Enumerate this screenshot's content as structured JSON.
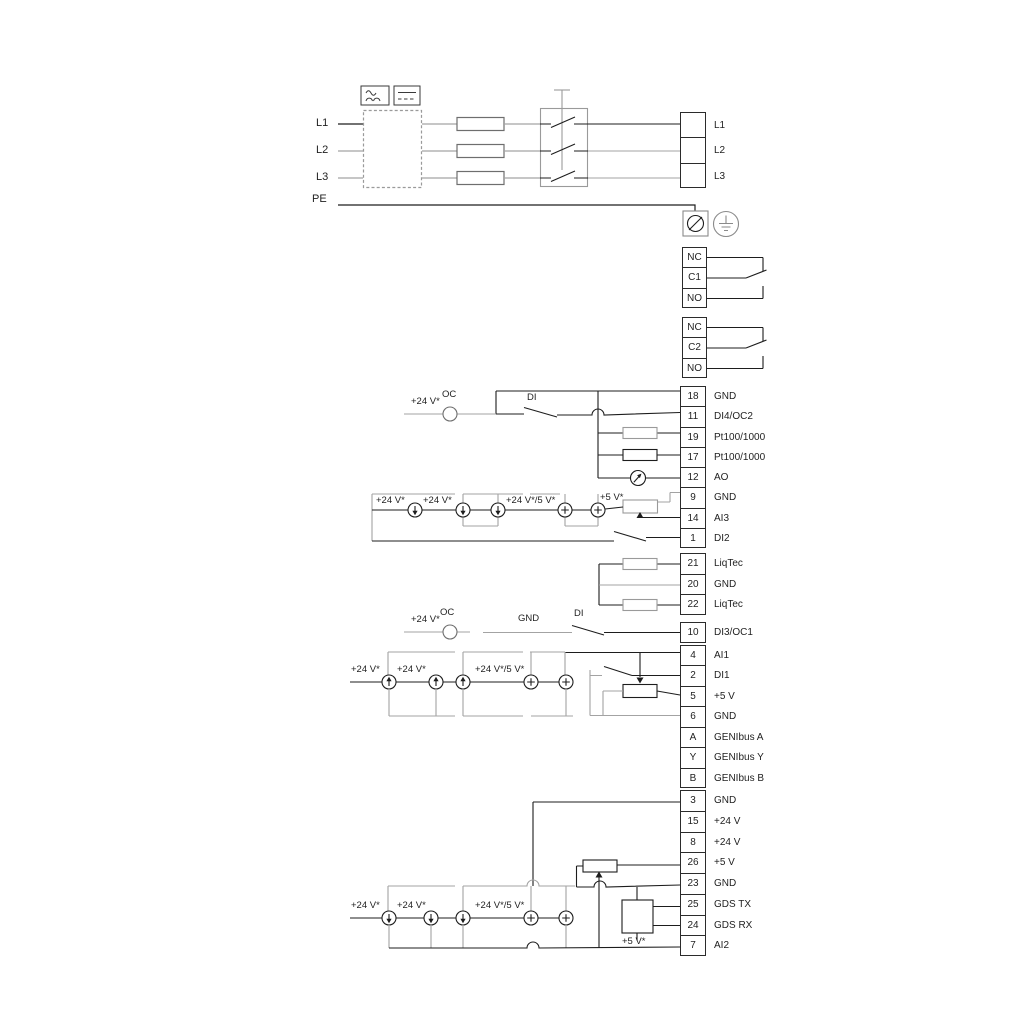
{
  "power": {
    "in_l1": "L1",
    "in_l2": "L2",
    "in_l3": "L3",
    "pe": "PE"
  },
  "groups": {
    "power_out": [
      {
        "label": "L1"
      },
      {
        "label": "L2"
      },
      {
        "label": "L3"
      }
    ],
    "relay1": [
      {
        "num": "NC"
      },
      {
        "num": "C1"
      },
      {
        "num": "NO"
      }
    ],
    "relay2": [
      {
        "num": "NC"
      },
      {
        "num": "C2"
      },
      {
        "num": "NO"
      }
    ],
    "io1": [
      {
        "num": "18",
        "label": "GND"
      },
      {
        "num": "11",
        "label": "DI4/OC2"
      },
      {
        "num": "19",
        "label": "Pt100/1000"
      },
      {
        "num": "17",
        "label": "Pt100/1000"
      },
      {
        "num": "12",
        "label": "AO"
      },
      {
        "num": "9",
        "label": "GND"
      },
      {
        "num": "14",
        "label": "AI3"
      },
      {
        "num": "1",
        "label": "DI2"
      }
    ],
    "liqtec": [
      {
        "num": "21",
        "label": "LiqTec"
      },
      {
        "num": "20",
        "label": "GND"
      },
      {
        "num": "22",
        "label": "LiqTec"
      }
    ],
    "di3": [
      {
        "num": "10",
        "label": "DI3/OC1"
      }
    ],
    "io2": [
      {
        "num": "4",
        "label": "AI1"
      },
      {
        "num": "2",
        "label": "DI1"
      },
      {
        "num": "5",
        "label": "+5 V"
      },
      {
        "num": "6",
        "label": "GND"
      },
      {
        "num": "A",
        "label": "GENIbus A"
      },
      {
        "num": "Y",
        "label": "GENIbus Y"
      },
      {
        "num": "B",
        "label": "GENIbus B"
      }
    ],
    "io3": [
      {
        "num": "3",
        "label": "GND"
      },
      {
        "num": "15",
        "label": "+24 V"
      },
      {
        "num": "8",
        "label": "+24 V"
      },
      {
        "num": "26",
        "label": "+5 V"
      },
      {
        "num": "23",
        "label": "GND"
      },
      {
        "num": "25",
        "label": "GDS TX"
      },
      {
        "num": "24",
        "label": "GDS RX"
      },
      {
        "num": "7",
        "label": "AI2"
      }
    ]
  },
  "annotations": {
    "s1_24v": "+24 V*",
    "s1_oc": "OC",
    "s1_di": "DI",
    "ai3_24v_1": "+24 V*",
    "ai3_24v_2": "+24 V*",
    "ai3_mix": "+24 V*/5 V*",
    "ai3_5v": "+5 V*",
    "s2_24v": "+24 V*",
    "s2_oc": "OC",
    "s2_gnd": "GND",
    "s2_di": "DI",
    "ai1_24v_1": "+24 V*",
    "ai1_24v_2": "+24 V*",
    "ai1_mix": "+24 V*/5 V*",
    "ai2_24v_1": "+24 V*",
    "ai2_24v_2": "+24 V*",
    "ai2_mix": "+24 V*/5 V*",
    "ai2_5v": "+5 V*"
  },
  "colors": {
    "wire_dark": "#1d1d1d",
    "wire_gray": "#a3a3a3",
    "text": "#1f1f1f"
  }
}
